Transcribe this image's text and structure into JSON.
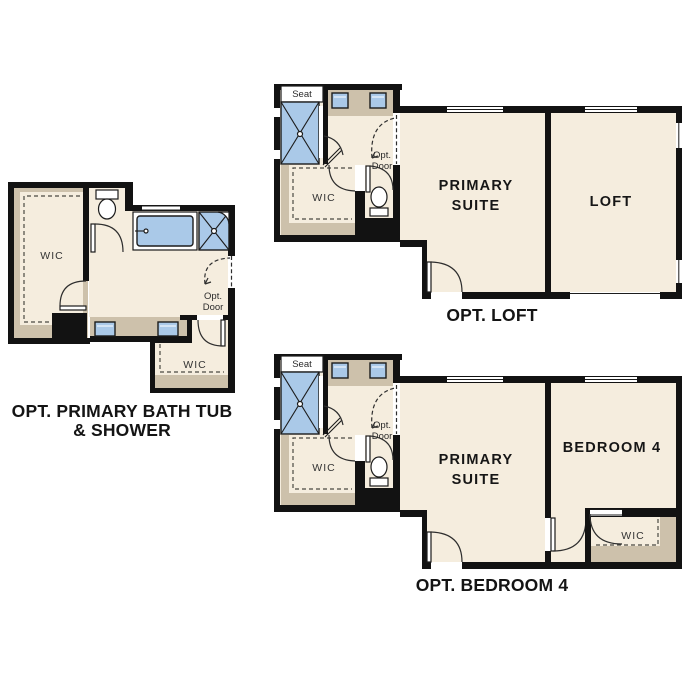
{
  "colors": {
    "wall": "#121212",
    "floor": "#f5edde",
    "tan": "#cdc1ab",
    "blue": "#aac9e8",
    "dark": "#1c1c1c"
  },
  "plans": {
    "bath": {
      "title_line1": "OPT. PRIMARY BATH TUB",
      "title_line2": "& SHOWER",
      "labels": {
        "wic_left": "WIC",
        "wic_right": "WIC",
        "opt_door_line1": "Opt.",
        "opt_door_line2": "Door"
      }
    },
    "loft": {
      "title": "OPT. LOFT",
      "labels": {
        "seat": "Seat",
        "wic": "WIC",
        "opt_door_line1": "Opt.",
        "opt_door_line2": "Door",
        "primary_line1": "PRIMARY",
        "primary_line2": "SUITE",
        "loft": "LOFT"
      }
    },
    "bedroom4": {
      "title": "OPT. BEDROOM 4",
      "labels": {
        "seat": "Seat",
        "wic": "WIC",
        "opt_door_line1": "Opt.",
        "opt_door_line2": "Door",
        "primary_line1": "PRIMARY",
        "primary_line2": "SUITE",
        "bedroom": "BEDROOM 4",
        "wic2": "WIC"
      }
    }
  }
}
